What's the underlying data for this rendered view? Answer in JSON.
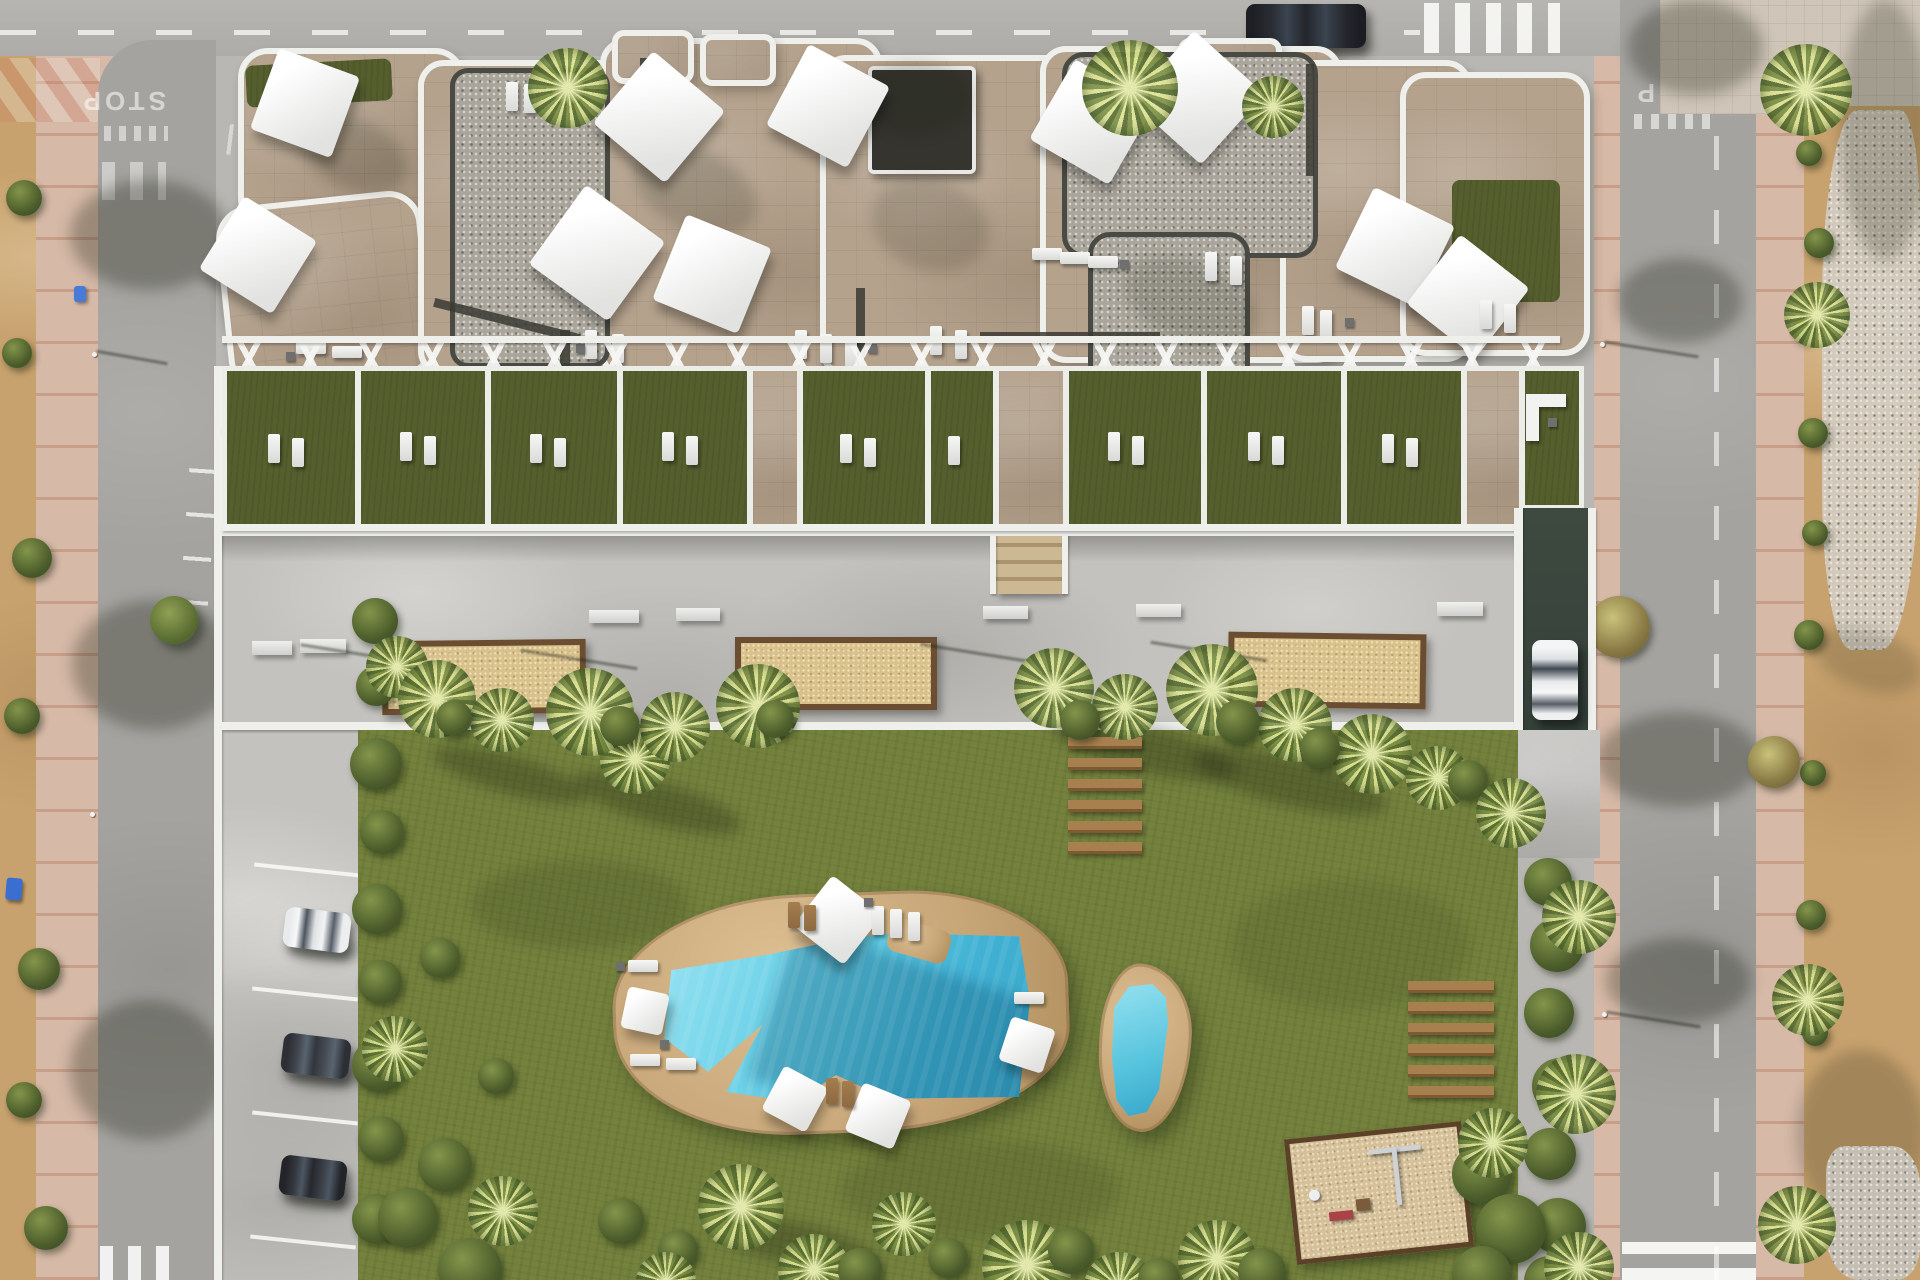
{
  "scene": {
    "title": "Aerial render of residential complex with rooftop terraces, plaza, garden, pools and playground"
  },
  "road_markings": {
    "stop_left": "STOP",
    "stop_right": "STOP"
  },
  "objects": {
    "planter_count": 3,
    "pool_count": 2,
    "parked_cars": 4,
    "street_car": 1,
    "garden_plank_steps": 6,
    "sun_deck_planks": 6
  },
  "colors": {
    "lawn": "#75823e",
    "terrace_grass": "#555f2e",
    "concrete": "#c3c2be",
    "road": "#a5a3a0",
    "road_light": "#b5b3af",
    "stone": "#b4a28d",
    "gravel": "#a9a59a",
    "parapet": "#efefec",
    "dark_wall": "#3b3a33",
    "sand": "#d9c18c",
    "planter_border": "#6b4e31",
    "deck": "#c7a678",
    "water": "#5ec9e2",
    "water_deep": "#2f9dc2",
    "sidewalk_pink": "#d6b9a7",
    "dirt": "#c8a26e",
    "rock": "#d3ccc0",
    "hedge": "#46582b",
    "wood": "#a87f4e",
    "ramp": "#3e4a40",
    "mulch": "#d5c09a"
  }
}
